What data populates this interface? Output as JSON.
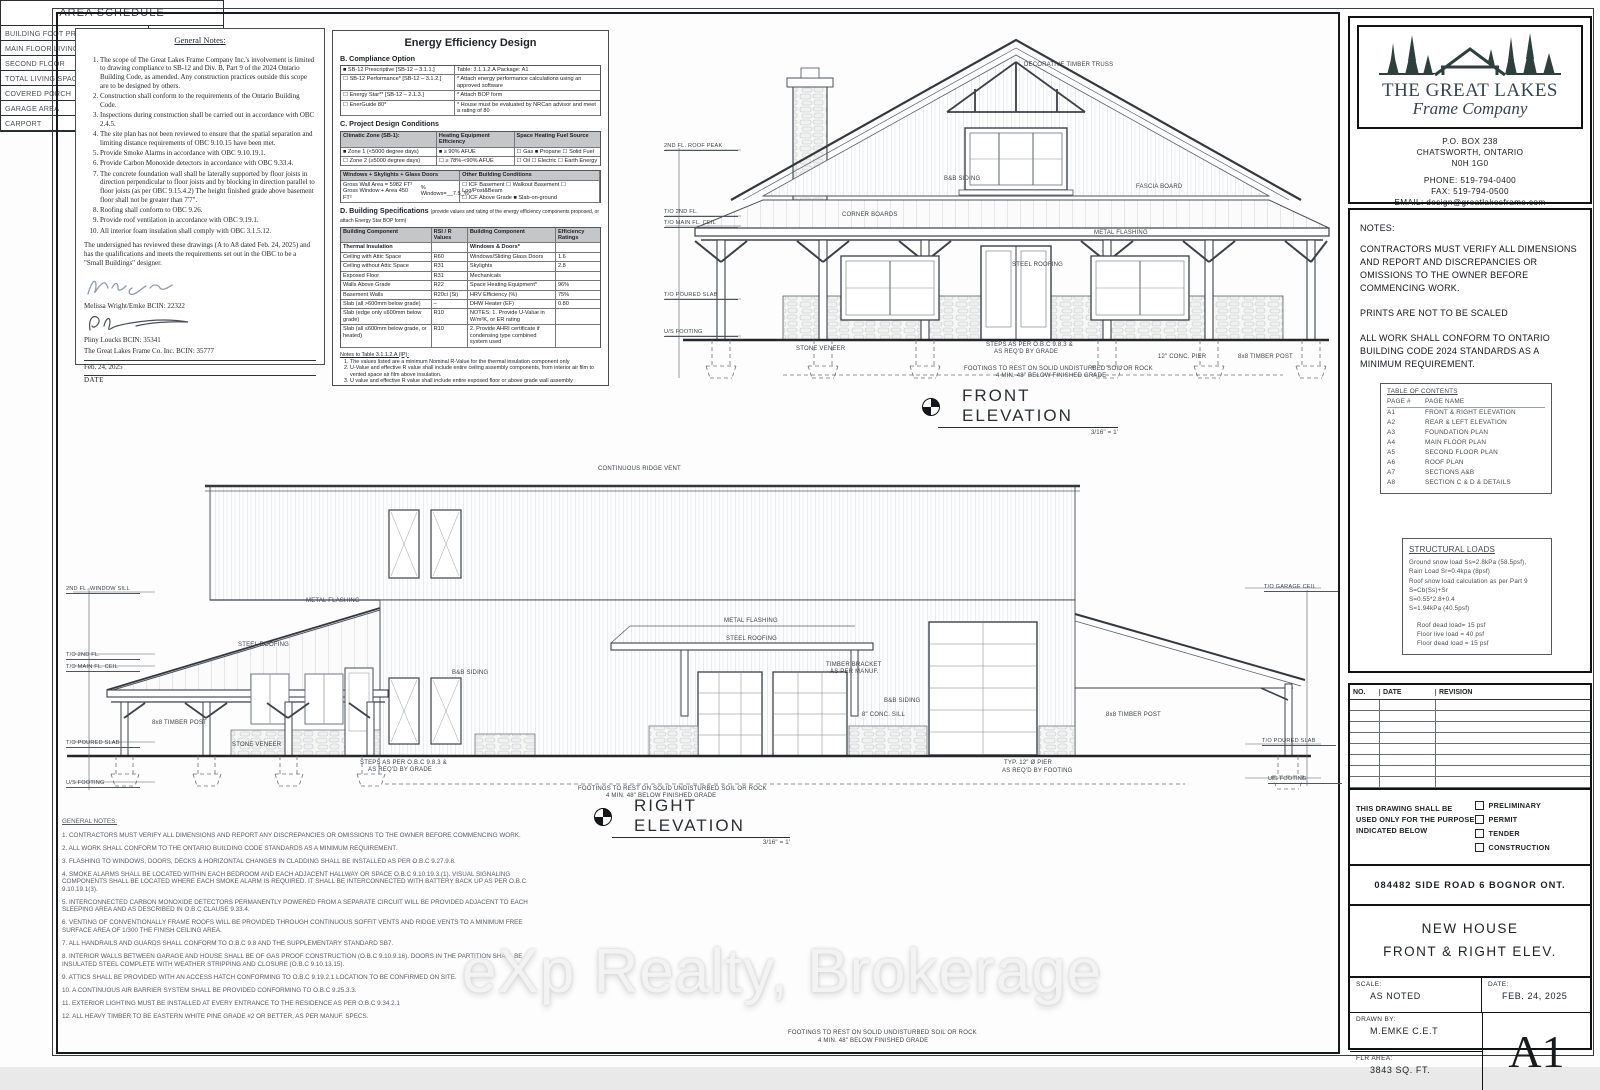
{
  "colors": {
    "paper": "#ffffff",
    "page_bg": "#e9e9e9",
    "line": "#3c4147",
    "logo": "#2e3f3c",
    "watermark": "#f3f3f3"
  },
  "watermark": "eXp Realty, Brokerage",
  "general_notes_box": {
    "title": "General Notes:",
    "items": [
      "The scope of The Great Lakes Frame Company Inc.'s involvement is limited to drawing compliance to SB-12 and Div. B, Part 9 of the 2024 Ontario Building Code, as amended. Any construction practices outside this scope are to be designed by others.",
      "Construction shall conform to the requirements of the Ontario Building Code.",
      "Inspections during construction shall be carried out in accordance with OBC 2.4.5.",
      "The site plan has not been reviewed to ensure that the spatial separation and limiting distance requirements of OBC 9.10.15 have been met.",
      "Provide Smoke Alarms in accordance with OBC 9.10.19.1.",
      "Provide Carbon Monoxide detectors in accordance with OBC 9.33.4.",
      "The concrete foundation wall shall be laterally supported by floor joists in direction perpendicular to floor joists and by blocking in direction parallel to floor joists (as per OBC 9.15.4.2) The height finished grade above basement floor shall not be greater than 7'7\".",
      "Roofing shall conform to OBC 9.26.",
      "Provide roof ventilation in accordance with OBC 9.19.1.",
      "All interior foam insulation shall comply with OBC 3.1.5.12."
    ],
    "declaration": "The undersigned has reviewed these drawings (A to A8 dated Feb. 24, 2025) and has the qualifications and meets the requirements set out in the OBC to be a \"Small Buildings\" designer.",
    "designer1": "Melissa Wright/Emke   BCIN: 22322",
    "designer2": "Pliny Loucks      BCIN:  35341",
    "company_bcin": "The Great Lakes Frame Co. Inc.    BCIN: 35777",
    "date": "Feb. 24, 2025",
    "date_label": "DATE"
  },
  "energy": {
    "title": "Energy Efficiency Design",
    "section_b": "B. Compliance Option",
    "b_rows": [
      {
        "l": "■ SB-12 Prescriptive [SB-12 – 3.1.1.]",
        "r": "Table:    3.1.1.2.A       Package:  A1"
      },
      {
        "l": "☐ SB-12 Performance* [SB-12 – 3.1.2.]",
        "r": "* Attach energy performance calculations using an approved software"
      },
      {
        "l": "☐ Energy Star** [SB-12 – 2.1.3.]",
        "r": "* Attach BOP form"
      },
      {
        "l": "☐ EnerGuide 80*",
        "r": "* House must be evaluated by NRCan advisor and meet a rating of 80"
      }
    ],
    "section_c": "C. Project Design Conditions",
    "c_headers": [
      "Climatic Zone (SB-1):",
      "Heating Equipment Efficiency",
      "Space Heating Fuel Source"
    ],
    "c_rows": [
      [
        "■ Zone 1 (<5000 degree days)",
        "■ ≥ 90% AFUE",
        "☐ Gas     ■ Propane     ☐ Solid Fuel"
      ],
      [
        "☐ Zone 2 (≥5000 degree days)",
        "☐ ≥ 78%-<90% AFUE",
        "☐ Oil      ☐ Electric     ☐ Earth Energy"
      ]
    ],
    "w_header": "Windows + Skylights + Glass Doors",
    "o_header": "Other Building Conditions",
    "w_line1": "Gross Wall Area =     5982 FT²",
    "w_line2": "Gross Window + Area  450 FT²",
    "w_pct": "% Windows=__7.5_%",
    "o_line1": "☐ ICF Basement   ☐ Walkout Basement   ☐ Log/Post&Beam",
    "o_line2": "☐ ICF Above Grade       ■ Slab-on-ground",
    "section_d": "D. Building Specifications",
    "section_d_note": "(provide values and rating of the energy efficiency components proposed, or attach Energy Star BOP form)",
    "d_headers": [
      "Building Component",
      "RSI / R Values",
      "Building Component",
      "Efficiency Ratings"
    ],
    "d_sub": [
      "Thermal Insulation",
      "",
      "Windows & Doors*",
      ""
    ],
    "d_rows": [
      [
        "Ceiling with Attic Space",
        "R60",
        "Windows/Sliding Glass Doors",
        "1.6"
      ],
      [
        "Ceiling without Attic Space",
        "R31",
        "Skylights",
        "2.8"
      ],
      [
        "Exposed Floor",
        "R31",
        "Mechanicals",
        ""
      ],
      [
        "Walls Above Grade",
        "R22",
        "Space Heating Equipment*",
        "96%"
      ],
      [
        "Basement Walls",
        "R20ci (Si)",
        "HRV Efficiency (%)",
        "75%"
      ],
      [
        "Slab (all >600mm below grade)",
        "–",
        "DHW Heater (EF)",
        "0.80"
      ],
      [
        "Slab (edge only ≤600mm below grade)",
        "R10",
        "NOTES: 1. Provide U-Value in W/m²K, or ER rating",
        ""
      ],
      [
        "Slab (all ≤600mm below grade, or heated)",
        "R10",
        "2. Provide AHRI certificate if condensing type combined system used",
        ""
      ]
    ],
    "notes_title": "Notes to Table 3.1.1.2.A (IP):",
    "notes": [
      "The values listed are a minimum Nominal R-Value for the thermal insulation component only",
      "U-Value and effective R value shall include entire ceiling assembly components, from interior air film to vented space air film above insulation.",
      "U value and effective R value shall include entire exposed floor or above grade wall assembly components, from interior air film to exterior air film.",
      "U value and effective R value shall include entire basement wall or slab assembly components and interior air film.",
      "U value is the overall coefficient of heat transfer for the window assembly, sliding glass door assembly or skylight assembly expressed in Btu/(h•ft²•F).",
      "In the case of basement wall assemblies, where R22ci is required R12 + 10ci is permitted to be used or vice versa; or where R12 + 5ci is required, R15ci is permitted to be used or vice versa.",
      "If and EF of a water tank is not indicated in a compliance package, there is no EF requirements for the water tank for that specific compliance package.",
      "Nominal and effective R values are expressed in (h•ft²•F)/Btu. U values are expressed in Btu/(h•ft²•F)."
    ]
  },
  "front_elevation": {
    "label": "FRONT ELEVATION",
    "scale": "3/16\" = 1'"
  },
  "right_elevation": {
    "label": "RIGHT ELEVATION",
    "scale": "3/16\" = 1'"
  },
  "annotations": [
    {
      "x": 1024,
      "y": 62,
      "t": "DECORATIVE TIMBER TRUSS"
    },
    {
      "x": 1136,
      "y": 184,
      "t": "FASCIA BOARD"
    },
    {
      "x": 842,
      "y": 212,
      "t": "CORNER BOARDS"
    },
    {
      "x": 944,
      "y": 176,
      "t": "B&B SIDING"
    },
    {
      "x": 1012,
      "y": 262,
      "t": "STEEL ROOFING"
    },
    {
      "x": 1094,
      "y": 230,
      "t": "METAL FLASHING"
    },
    {
      "x": 796,
      "y": 346,
      "t": "STONE VENEER"
    },
    {
      "x": 1238,
      "y": 354,
      "t": "8x8 TIMBER POST"
    },
    {
      "x": 1158,
      "y": 354,
      "t": "12\" CONC. PIER"
    },
    {
      "x": 986,
      "y": 342,
      "t": "STEPS AS PER O.B.C 9.8.3 &"
    },
    {
      "x": 994,
      "y": 349,
      "t": "AS REQ'D BY GRADE"
    },
    {
      "x": 964,
      "y": 366,
      "t": "FOOTINGS TO REST ON SOLID UNDISTURBED SOIL OR ROCK"
    },
    {
      "x": 996,
      "y": 373,
      "t": "4 MIN. 48\" BELOW FINISHED GRADE"
    },
    {
      "x": 664,
      "y": 143,
      "t": "2ND FL. ROOF PEAK",
      "cls": "lvl"
    },
    {
      "x": 664,
      "y": 209,
      "t": "T/O 2ND FL.",
      "cls": "lvl"
    },
    {
      "x": 664,
      "y": 220,
      "t": "T/O MAIN FL. CEIL",
      "cls": "lvl"
    },
    {
      "x": 664,
      "y": 292,
      "t": "T/O POURED SLAB",
      "cls": "lvl"
    },
    {
      "x": 664,
      "y": 329,
      "t": "U/S FOOTING",
      "cls": "lvl"
    },
    {
      "x": 598,
      "y": 466,
      "t": "CONTINUOUS RIDGE VENT"
    },
    {
      "x": 238,
      "y": 642,
      "t": "STEEL ROOFING"
    },
    {
      "x": 306,
      "y": 598,
      "t": "METAL FLASHING"
    },
    {
      "x": 452,
      "y": 670,
      "t": "B&B SIDING"
    },
    {
      "x": 724,
      "y": 618,
      "t": "METAL FLASHING"
    },
    {
      "x": 726,
      "y": 636,
      "t": "STEEL ROOFING"
    },
    {
      "x": 152,
      "y": 720,
      "t": "8x8 TIMBER POST"
    },
    {
      "x": 232,
      "y": 742,
      "t": "STONE VENEER"
    },
    {
      "x": 826,
      "y": 662,
      "t": "TIMBER BRACKET"
    },
    {
      "x": 830,
      "y": 669,
      "t": "AS PER MANUF."
    },
    {
      "x": 862,
      "y": 712,
      "t": "8\" CONC. SILL"
    },
    {
      "x": 884,
      "y": 698,
      "t": "B&B SIDING"
    },
    {
      "x": 1106,
      "y": 712,
      "t": "8x8 TIMBER POST"
    },
    {
      "x": 360,
      "y": 760,
      "t": "STEPS AS PER O.B.C 9.8.3 &"
    },
    {
      "x": 368,
      "y": 767,
      "t": "AS REQ'D BY GRADE"
    },
    {
      "x": 1004,
      "y": 760,
      "t": "TYP. 12\" Ø PIER"
    },
    {
      "x": 1002,
      "y": 768,
      "t": "AS REQ'D BY FOOTING"
    },
    {
      "x": 578,
      "y": 786,
      "t": "FOOTINGS TO REST ON SOLID UNDISTURBED SOIL OR ROCK"
    },
    {
      "x": 606,
      "y": 793,
      "t": "4 MIN. 48\" BELOW FINISHED GRADE"
    },
    {
      "x": 788,
      "y": 1030,
      "t": "FOOTINGS TO REST ON SOLID UNDISTURBED SOIL OR ROCK"
    },
    {
      "x": 818,
      "y": 1038,
      "t": "4 MIN. 48\" BELOW FINISHED GRADE"
    },
    {
      "x": 66,
      "y": 586,
      "t": "2ND FL. WINDOW SILL",
      "cls": "lvl"
    },
    {
      "x": 66,
      "y": 652,
      "t": "T/O 2ND FL.",
      "cls": "lvl"
    },
    {
      "x": 66,
      "y": 664,
      "t": "T/O MAIN FL. CEIL",
      "cls": "lvl"
    },
    {
      "x": 66,
      "y": 740,
      "t": "T/O POURED SLAB",
      "cls": "lvl"
    },
    {
      "x": 66,
      "y": 780,
      "t": "U/S FOOTING",
      "cls": "lvl"
    },
    {
      "x": 1264,
      "y": 584,
      "t": "T/O GARAGE CEIL",
      "cls": "lvl"
    },
    {
      "x": 1262,
      "y": 738,
      "t": "T/O POURED SLAB",
      "cls": "lvl"
    },
    {
      "x": 1268,
      "y": 776,
      "t": "U/S FOOTING",
      "cls": "lvl"
    }
  ],
  "bottom_notes": {
    "title": "GENERAL NOTES:",
    "items": [
      "1. CONTRACTORS MUST VERIFY ALL DIMENSIONS AND REPORT ANY DISCREPANCIES OR OMISSIONS TO THE OWNER BEFORE COMMENCING WORK.",
      "2. ALL WORK SHALL CONFORM TO THE ONTARIO BUILDING CODE STANDARDS AS A MINIMUM REQUIREMENT.",
      "3. FLASHING TO WINDOWS, DOORS, DECKS & HORIZONTAL CHANGES IN CLADDING SHALL BE INSTALLED AS PER O.B.C 9.27.9.8.",
      "4. SMOKE ALARMS SHALL BE LOCATED WITHIN EACH BEDROOM AND EACH ADJACENT HALLWAY OR SPACE O.B.C 9.10.19.3.(1). VISUAL SIGNALING COMPONENTS SHALL BE LOCATED WHERE EACH SMOKE ALARM IS REQUIRED. IT SHALL BE INTERCONNECTED WITH BATTERY BACK UP AS PER O.B.C 9.10.19.1(3).",
      "5. INTERCONNECTED CARBON MONOXIDE DETECTORS PERMANENTLY POWERED FROM A SEPARATE CIRCUIT WILL BE PROVIDED ADJACENT TO EACH SLEEPING AREA AND AS DESCRIBED IN O.B.C CLAUSE 9.33.4.",
      "6. VENTING OF CONVENTIONALLY FRAME ROOFS WILL BE PROVIDED THROUGH CONTINUOUS SOFFIT VENTS AND RIDGE VENTS TO A MINIMUM FREE SURFACE AREA OF 1/300 THE FINISH CEILING AREA.",
      "7. ALL HANDRAILS AND GUARDS SHALL CONFORM TO O.B.C 9.8 AND THE SUPPLEMENTARY STANDARD SB7.",
      "8. INTERIOR WALLS BETWEEN GARAGE AND HOUSE SHALL BE OF GAS PROOF CONSTRUCTION (O.B.C 9.10.9.16). DOORS IN THE PARTITION SHALL BE INSULATED STEEL COMPLETE WITH WEATHER STRIPPING AND CLOSURE (O.B.C 9.10.13.15).",
      "9. ATTICS SHALL BE PROVIDED WITH AN ACCESS HATCH CONFORMING TO O.B.C 9.19.2.1 LOCATION TO BE CONFIRMED ON SITE.",
      "10. A CONTINUOUS AIR BARRIER SYSTEM SHALL BE PROVIDED CONFORMING TO O.B.C 9.25.3.3.",
      "11. EXTERIOR LIGHTING MUST BE INSTALLED AT EVERY ENTRANCE TO THE RESIDENCE AS PER O.B.C 9.34.2.1",
      "12. ALL HEAVY TIMBER TO BE EASTERN WHITE PINE GRADE #2 OR BETTER, AS PER MANUF. SPECS."
    ]
  },
  "area_schedule": {
    "title": "AREA SCHEDULE",
    "rows": [
      {
        "label": "BUILDING FOOT PRINT",
        "value": "4904  SQ. FT."
      },
      {
        "label": "MAIN FLOOR LIVING SPACE",
        "value": "2423  SQ. FT."
      },
      {
        "label": "SECOND FLOOR",
        "value": "1420 SQ. FT."
      },
      {
        "label": "TOTAL LIVING SPACE",
        "value": "3843  SQ. FT."
      },
      {
        "label": "COVERED PORCH",
        "value": "1623 SQ. FT."
      },
      {
        "label": "GARAGE AREA",
        "value": "2481 SQ. FT."
      },
      {
        "label": "CARPORT",
        "value": "668 SQ. FT."
      }
    ]
  },
  "title_block": {
    "company_line1": "THE GREAT LAKES",
    "company_line2": "Frame Company",
    "address": [
      "P.O.  BOX  238",
      "CHATSWORTH,  ONTARIO",
      "N0H  1G0"
    ],
    "contact": [
      "PHONE:  519-794-0400",
      "FAX:  519-794-0500",
      "EMAIL:  design@greatlakesframe.com"
    ],
    "notes_title": "NOTES:",
    "notes": [
      "CONTRACTORS MUST VERIFY ALL DIMENSIONS AND REPORT AND DISCREPANCIES OR OMISSIONS TO THE OWNER BEFORE COMMENCING WORK.",
      "PRINTS ARE NOT TO BE SCALED",
      "ALL WORK SHALL CONFORM TO ONTARIO BUILDING CODE 2024 STANDARDS AS A MINIMUM REQUIREMENT."
    ],
    "toc_title": "TABLE OF CONTENTS",
    "toc_col1": "PAGE #",
    "toc_col2": "PAGE NAME",
    "toc": [
      {
        "page": "A1",
        "name": "FRONT & RIGHT ELEVATION"
      },
      {
        "page": "A2",
        "name": "REAR & LEFT ELEVATION"
      },
      {
        "page": "A3",
        "name": "FOUNDATION PLAN"
      },
      {
        "page": "A4",
        "name": "MAIN FLOOR PLAN"
      },
      {
        "page": "A5",
        "name": "SECOND FLOOR PLAN"
      },
      {
        "page": "A6",
        "name": "ROOF PLAN"
      },
      {
        "page": "A7",
        "name": "SECTIONS A&B"
      },
      {
        "page": "A8",
        "name": "SECTION C & D & DETAILS"
      }
    ],
    "loads_title": "STRUCTURAL LOADS",
    "loads": [
      "Ground snow load Ss=2.8kPa (58.5psf),",
      "Rain Load Sr=0.4kpa (8psf)",
      "Roof snow load calculation as per Part 9",
      "S=Cb(Ss)+Sr",
      "S=0.55*2.8+0.4",
      "S=1.94kPa (40.5psf)"
    ],
    "loads2": [
      "Roof dead load=  15 psf",
      "Floor live load =   40 psf",
      "Floor dead load =  15 psf"
    ],
    "rev_headers": [
      "NO.",
      "DATE",
      "REVISION"
    ],
    "rev_rows": [
      [
        "",
        "",
        ""
      ],
      [
        "",
        "",
        ""
      ],
      [
        "",
        "",
        ""
      ],
      [
        "",
        "",
        ""
      ],
      [
        "",
        "",
        ""
      ],
      [
        "",
        "",
        ""
      ],
      [
        "",
        "",
        ""
      ],
      [
        "",
        "",
        ""
      ]
    ],
    "purpose_text": "THIS DRAWING SHALL BE USED ONLY FOR THE PURPOSE INDICATED BELOW",
    "purpose_options": [
      "PRELIMINARY",
      "PERMIT",
      "TENDER",
      "CONSTRUCTION"
    ],
    "project_address": "084482  SIDE  ROAD  6  BOGNOR  ONT.",
    "sheet_title1": "NEW  HOUSE",
    "sheet_title2": "FRONT  &  RIGHT  ELEV.",
    "scale_label": "SCALE:",
    "scale": "AS  NOTED",
    "date_label": "DATE:",
    "date": "FEB.  24,  2025",
    "drawn_label": "DRAWN  BY:",
    "drawn": "M.EMKE  C.E.T",
    "flr_label": "FLR  AREA:",
    "flr": "3843  SQ.  FT.",
    "sheet_no": "A1"
  }
}
